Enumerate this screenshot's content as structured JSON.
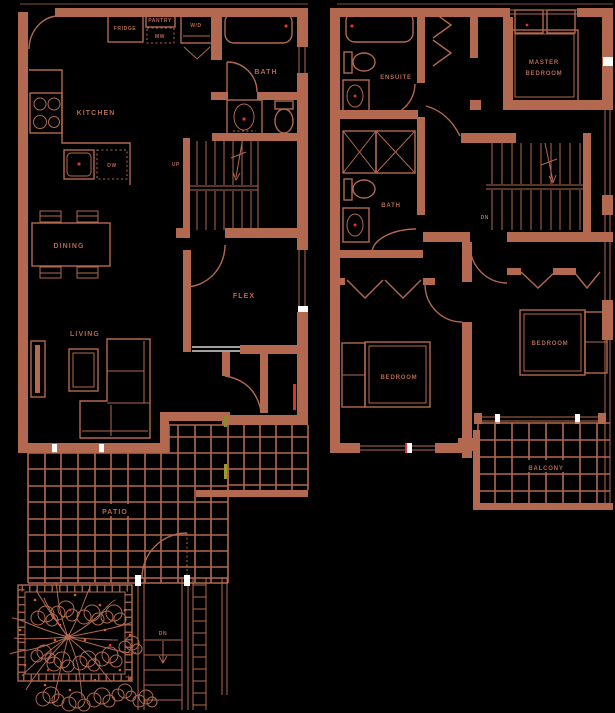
{
  "colors": {
    "background": "#000000",
    "line": "#B2694F",
    "accent_red": "#E03226",
    "accent_white": "#FFFFFF",
    "accent_olive": "#8B8B2E",
    "accent_orange": "#D4622A"
  },
  "floor1": {
    "kitchen": "KITCHEN",
    "fridge": "FRIDGE",
    "pantry": "PANTRY",
    "microwave": "MW",
    "washer_dryer": "W/D",
    "dishwasher": "DW",
    "bath": "BATH",
    "stairs_up": "UP",
    "dining": "DINING",
    "flex": "FLEX",
    "living": "LIVING",
    "patio": "PATIO",
    "patio_steps_down": "DN"
  },
  "floor2": {
    "ensuite": "ENSUITE",
    "bath": "BATH",
    "master_bedroom_line1": "MASTER",
    "master_bedroom_line2": "BEDROOM",
    "stairs_down": "DN",
    "bedroom_left": "BEDROOM",
    "bedroom_right": "BEDROOM",
    "balcony": "BALCONY"
  }
}
